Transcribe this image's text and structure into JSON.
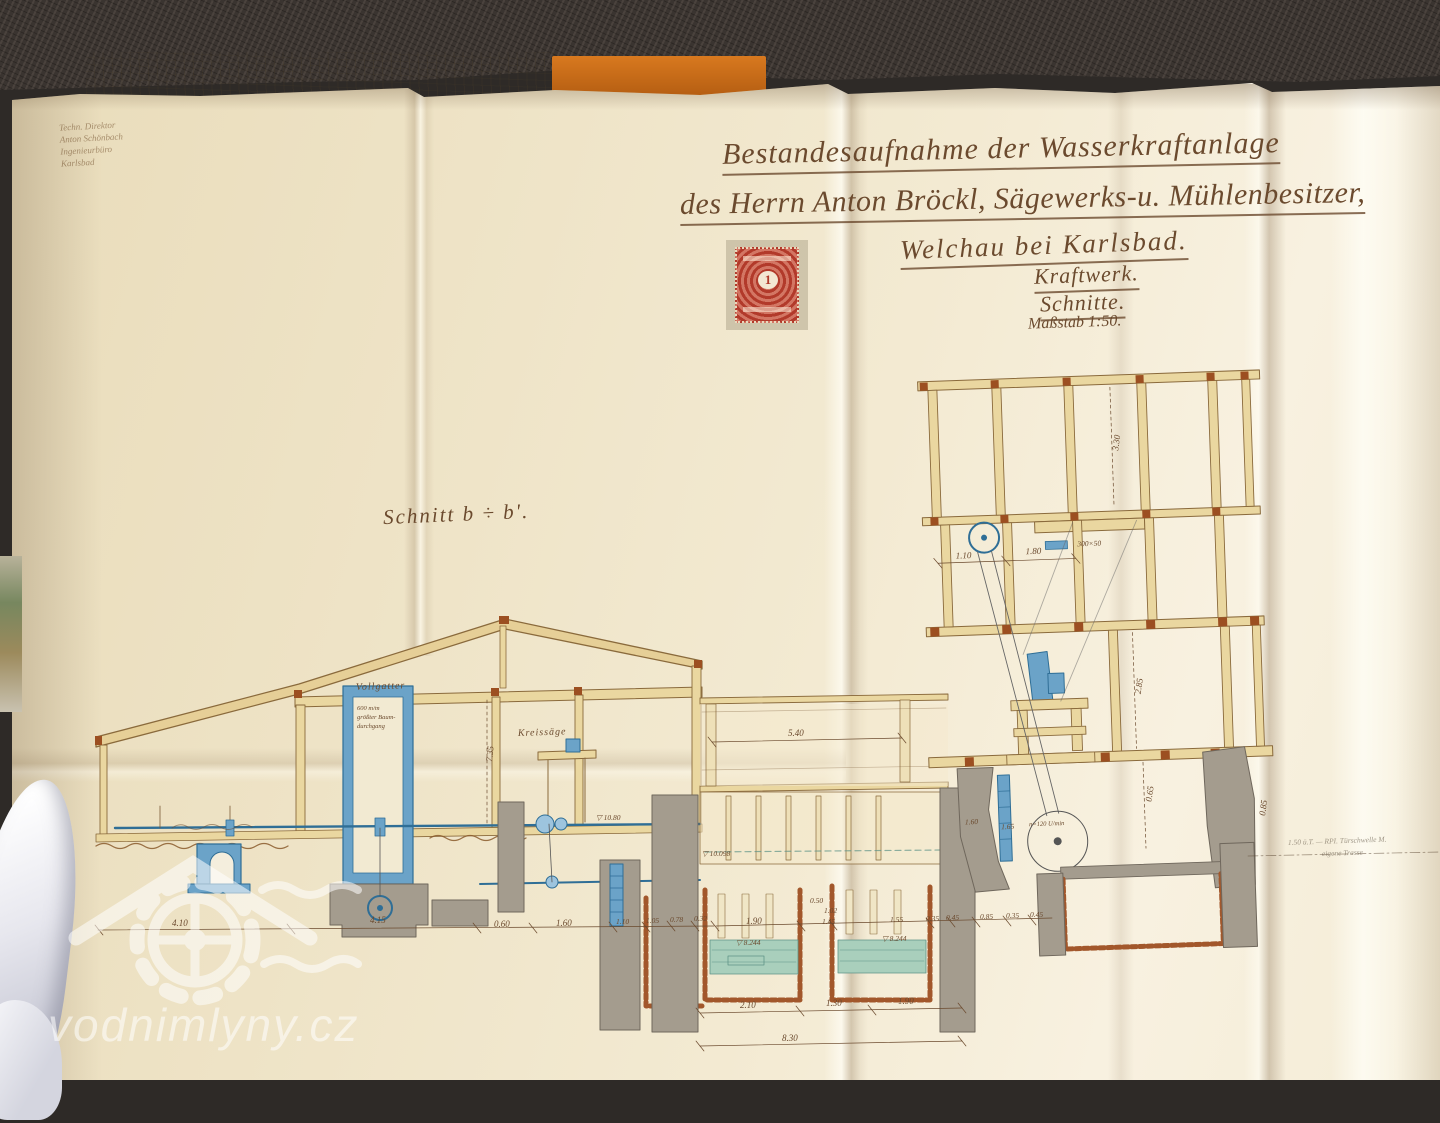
{
  "watermark": {
    "text": "vodnimlyny.cz"
  },
  "title_block": {
    "line1": "Bestandesaufnahme der Wasserkraftanlage",
    "line2": "des Herrn Anton Bröckl, Sägewerks-u. Mühlenbesitzer,",
    "line3": "Welchau bei Karlsbad.",
    "line4": "Kraftwerk.",
    "line5": "Schnitte.",
    "line6": "Maßstab 1:50."
  },
  "signature_block": {
    "line1": "Techn. Direktor",
    "line2": "Anton Schönbach",
    "line3": "Ingenieurbüro",
    "line4": "Karlsbad"
  },
  "stamp": {
    "value": "1"
  },
  "section_label": "Schnitt b ÷ b'.",
  "labels": {
    "vollgatter": "Vollgatter",
    "vollgatter_note1": "600 m/m",
    "vollgatter_note2": "größter Baum-",
    "vollgatter_note3": "durchgang",
    "kreissaege": "Kreissäge",
    "rpm": "n=120 U/min",
    "beam_size": "300×50"
  },
  "pencil_note": {
    "line1": "1.50 ü.T. — RPI. Türschwelle M.",
    "line2": "eigene Trasse"
  },
  "levels": {
    "l1": "▽ 10.80",
    "l2": "▽ 10.098",
    "l3": "▽ 8.244",
    "l4": "▽ 8.244"
  },
  "dims": [
    "7.35",
    "5.40",
    "3.30",
    "1.10",
    "1.80",
    "2.85",
    "0.65",
    "0.85",
    "1.60",
    "1.65",
    "4.10",
    "4.15",
    "0.60",
    "1.60",
    "1.10",
    "1.05",
    "0.78",
    "0.32",
    "1.90",
    "0.50",
    "1.02",
    "1.45",
    "1.55",
    "0.35",
    "0.45",
    "0.85",
    "0.35",
    "0.45",
    "2.10",
    "1.30",
    "1.90",
    "8.30"
  ]
}
